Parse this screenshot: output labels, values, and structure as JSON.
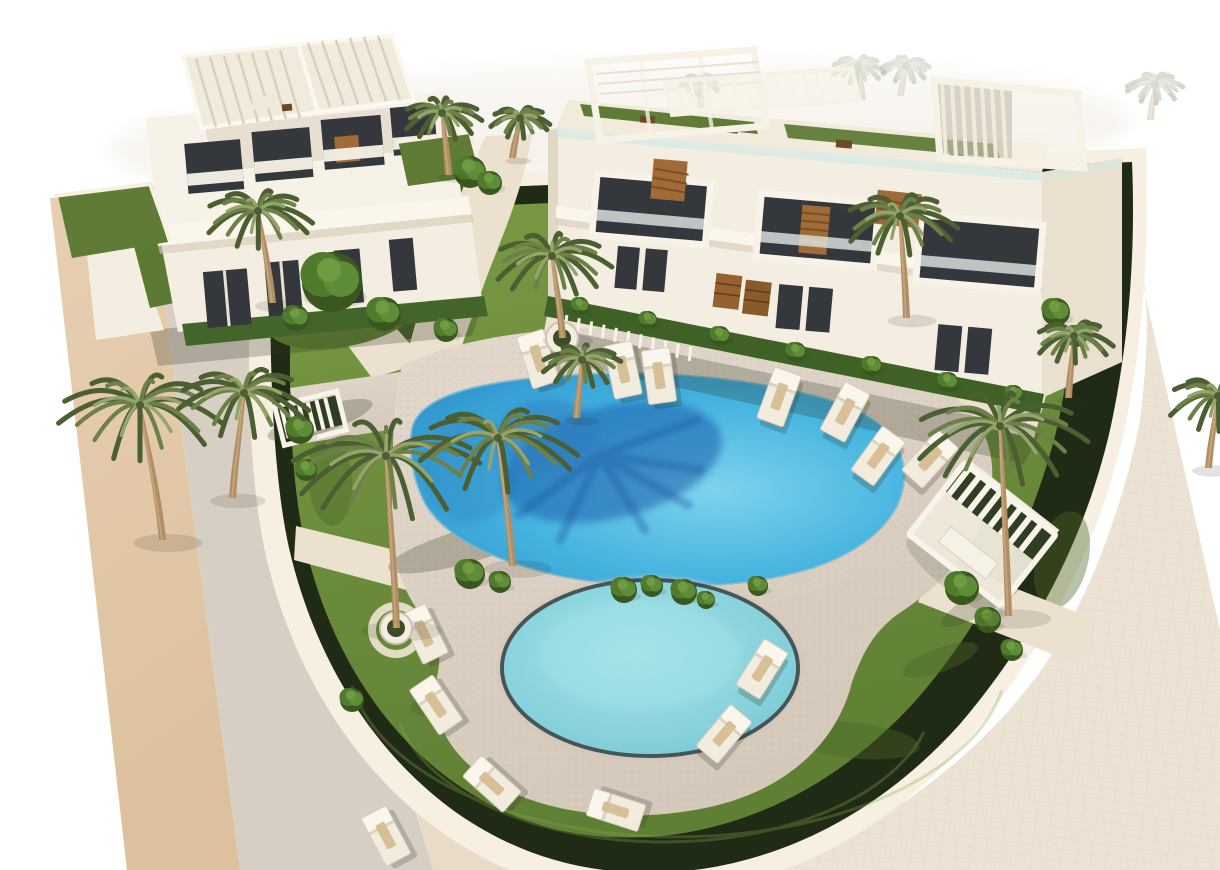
{
  "scene": {
    "type": "architectural-3d-render",
    "subject": "Aerial 3D rendering of a new-build residential complex: two modern white apartment buildings with rooftop pergolas and glass balconies, landscaped gardens with palm trees, a large lagoon-style swimming pool with a palm shadow on the water, a smaller round pool ringed by sun loungers, a beige road on the left and a pale tiled sidewalk on the right",
    "objects": {
      "buildings": 2,
      "swimming_pools": 2,
      "sun_loungers": 14,
      "palm_trees": 13,
      "shrubs": 28,
      "pergolas": 2
    }
  },
  "palette": {
    "page": "#ffffff",
    "wash": "#f4f0e8",
    "roadTan": "#e3c8a9",
    "roadMid": "#d8cfc4",
    "roadCream": "#eadbc8",
    "curb": "#f7f0e2",
    "hedge": "#202b15",
    "grass": "#6f8e3e",
    "grassDark": "#597731",
    "grassLight": "#8aa751",
    "deck": "#dcd2c6",
    "deckDot": "#c2b6a6",
    "path": "#ece1cf",
    "sidewalk": "#ece3d4",
    "pool": "#45b4e0",
    "poolLight": "#7fd2ec",
    "poolDeep": "#2f93cc",
    "poolShadow": "#1c5fab",
    "smallPool": "#85d0da",
    "smallPoolLight": "#a5e3e8",
    "rimDark": "#223a41",
    "building": "#f4eee2",
    "buildingShade": "#e9e0d0",
    "slab": "#fbf6ec",
    "windowDark": "#34373c",
    "glass": "#cfe8e6",
    "wood": "#a06b37",
    "woodDark": "#7a4e26",
    "trunk": "#b18f66",
    "trunkLight": "#c4a379",
    "palmDark": "#4b5f33",
    "palmMid": "#6c8047",
    "palmLight": "#94a46b",
    "bush": "#507b2d",
    "bushDark": "#39571f",
    "lounger": "#f2ecdf",
    "loungerEdge": "#d7cdbc",
    "towel": "#d5bd93",
    "shadow": "rgba(45,52,32,0.25)"
  },
  "pools": {
    "main_pool": {
      "shape": "freeform lagoon",
      "water_color": "#45b4e0",
      "feature": "dark palm-tree shadow cast on the water"
    },
    "round_pool": {
      "cx": 650,
      "cy": 668,
      "rx": 146,
      "ry": 86,
      "water_color": "#85d0da"
    }
  },
  "palms": [
    {
      "x": 272,
      "y": 303,
      "h": 92,
      "lean": -14,
      "size": 55
    },
    {
      "x": 162,
      "y": 540,
      "h": 135,
      "lean": -22,
      "size": 82
    },
    {
      "x": 232,
      "y": 498,
      "h": 105,
      "lean": 12,
      "size": 66
    },
    {
      "x": 396,
      "y": 628,
      "h": 172,
      "lean": -10,
      "size": 95,
      "planter": true
    },
    {
      "x": 512,
      "y": 566,
      "h": 128,
      "lean": -14,
      "size": 80
    },
    {
      "x": 562,
      "y": 338,
      "h": 82,
      "lean": -10,
      "size": 60,
      "planter": true
    },
    {
      "x": 576,
      "y": 418,
      "h": 58,
      "lean": 6,
      "size": 40
    },
    {
      "x": 906,
      "y": 318,
      "h": 102,
      "lean": -6,
      "size": 58
    },
    {
      "x": 1008,
      "y": 616,
      "h": 190,
      "lean": -8,
      "size": 88
    },
    {
      "x": 1068,
      "y": 398,
      "h": 62,
      "lean": 6,
      "size": 40
    },
    {
      "x": 1208,
      "y": 468,
      "h": 72,
      "lean": 10,
      "size": 52
    },
    {
      "x": 448,
      "y": 175,
      "h": 62,
      "lean": -6,
      "size": 40
    },
    {
      "x": 512,
      "y": 158,
      "h": 40,
      "lean": 8,
      "size": 30
    }
  ],
  "background_palms": [
    {
      "x": 390,
      "y": 120,
      "h": 28,
      "lean": -8,
      "size": 22
    },
    {
      "x": 862,
      "y": 100,
      "h": 34,
      "lean": -4,
      "size": 26
    },
    {
      "x": 900,
      "y": 96,
      "h": 30,
      "lean": 6,
      "size": 24
    },
    {
      "x": 1150,
      "y": 120,
      "h": 36,
      "lean": 5,
      "size": 28
    },
    {
      "x": 700,
      "y": 108,
      "h": 26,
      "lean": 0,
      "size": 20
    }
  ],
  "loungers": [
    {
      "x": 538,
      "y": 359,
      "r": -18
    },
    {
      "x": 623,
      "y": 370,
      "r": -12
    },
    {
      "x": 659,
      "y": 376,
      "r": -8
    },
    {
      "x": 779,
      "y": 397,
      "r": 20
    },
    {
      "x": 845,
      "y": 412,
      "r": 28
    },
    {
      "x": 878,
      "y": 456,
      "r": 36
    },
    {
      "x": 930,
      "y": 459,
      "r": 42
    },
    {
      "x": 424,
      "y": 634,
      "r": -26
    },
    {
      "x": 436,
      "y": 705,
      "r": -34
    },
    {
      "x": 492,
      "y": 784,
      "r": -48
    },
    {
      "x": 616,
      "y": 810,
      "r": -72
    },
    {
      "x": 386,
      "y": 836,
      "r": -28
    },
    {
      "x": 762,
      "y": 669,
      "r": 32
    },
    {
      "x": 724,
      "y": 734,
      "r": 40
    }
  ],
  "bushes": [
    {
      "x": 332,
      "y": 282,
      "r": 30,
      "tree": true
    },
    {
      "x": 384,
      "y": 314,
      "r": 17
    },
    {
      "x": 296,
      "y": 318,
      "r": 13
    },
    {
      "x": 446,
      "y": 330,
      "r": 12
    },
    {
      "x": 470,
      "y": 172,
      "r": 16
    },
    {
      "x": 490,
      "y": 183,
      "r": 12
    },
    {
      "x": 470,
      "y": 574,
      "r": 15
    },
    {
      "x": 500,
      "y": 582,
      "r": 11
    },
    {
      "x": 624,
      "y": 590,
      "r": 13
    },
    {
      "x": 652,
      "y": 586,
      "r": 11
    },
    {
      "x": 684,
      "y": 592,
      "r": 13
    },
    {
      "x": 706,
      "y": 600,
      "r": 9
    },
    {
      "x": 758,
      "y": 586,
      "r": 10
    },
    {
      "x": 962,
      "y": 588,
      "r": 17
    },
    {
      "x": 988,
      "y": 620,
      "r": 13
    },
    {
      "x": 1012,
      "y": 650,
      "r": 11
    },
    {
      "x": 1056,
      "y": 312,
      "r": 14
    },
    {
      "x": 1076,
      "y": 336,
      "r": 11
    },
    {
      "x": 352,
      "y": 700,
      "r": 12
    },
    {
      "x": 300,
      "y": 430,
      "r": 14
    },
    {
      "x": 306,
      "y": 470,
      "r": 11
    },
    {
      "x": 580,
      "y": 306,
      "r": 9
    },
    {
      "x": 648,
      "y": 320,
      "r": 9
    },
    {
      "x": 720,
      "y": 336,
      "r": 10
    },
    {
      "x": 796,
      "y": 352,
      "r": 10
    },
    {
      "x": 872,
      "y": 366,
      "r": 10
    },
    {
      "x": 948,
      "y": 382,
      "r": 10
    },
    {
      "x": 1014,
      "y": 394,
      "r": 9
    }
  ],
  "fence": {
    "x1": 566,
    "y1": 322,
    "x2": 690,
    "y2": 354,
    "count": 11,
    "tilt": 7
  }
}
